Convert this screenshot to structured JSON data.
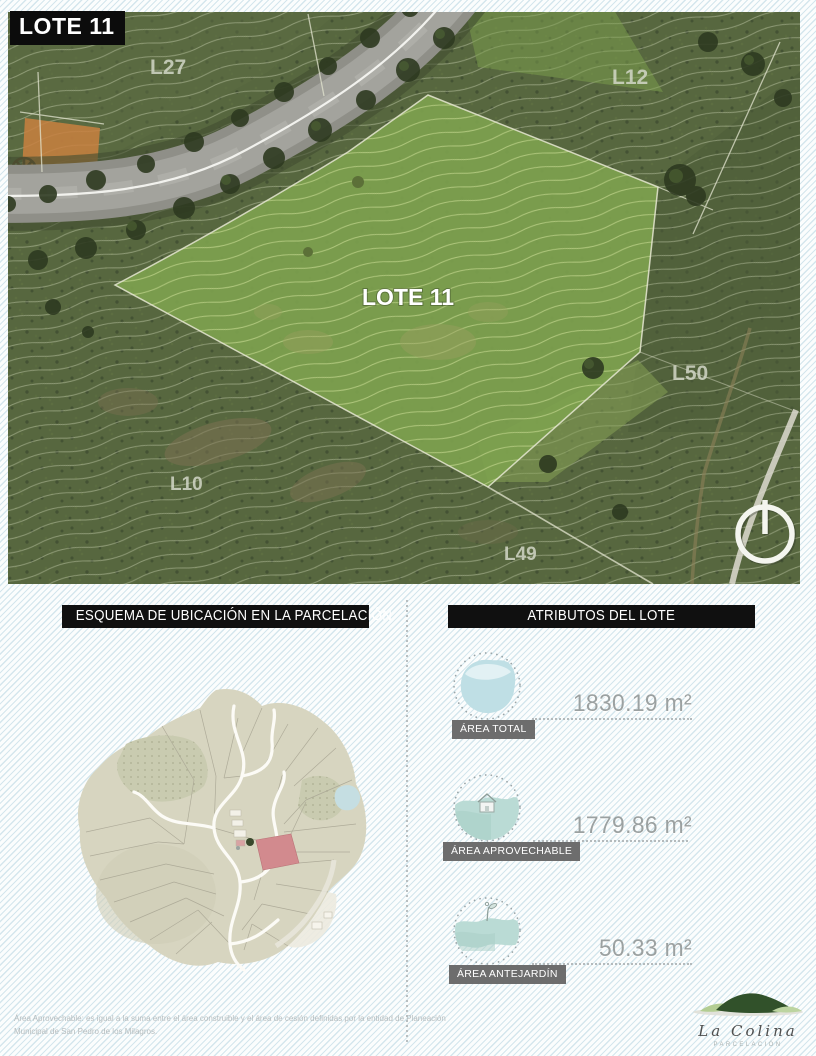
{
  "page": {
    "badge": "LOTE 11"
  },
  "aerial": {
    "center_label": "LOTE 11",
    "labels": {
      "l27": "L27",
      "l12": "L12",
      "l50": "L50",
      "l10": "L10",
      "l49": "L49"
    }
  },
  "location_section": {
    "header": "ESQUEMA DE UBICACIÓN EN LA PARCELACIÓN"
  },
  "attributes_section": {
    "header": "ATRIBUTOS DEL LOTE",
    "items": [
      {
        "label": "ÁREA TOTAL",
        "value": "1830.19 m²"
      },
      {
        "label": "ÁREA APROVECHABLE",
        "value": "1779.86 m²"
      },
      {
        "label": "ÁREA ANTEJARDÍN",
        "value": "50.33 m²"
      }
    ]
  },
  "footnote": {
    "line1": "Área Aprovechable: es igual a la suma entre el área construible y el área de cesión definidas por la entidad de Planeación",
    "line2": "Municipal de San Pedro de los Milagros."
  },
  "logo": {
    "name": "La Colina",
    "tagline": "PARCELACIÓN"
  },
  "colors": {
    "header_black": "#101010",
    "chip_gray": "#6d6d6d",
    "value_gray": "#9ba1a1",
    "lot_highlight_red": "#d28a8e",
    "aerial_base_green": "#57673f",
    "lot_bright_green": "#7da14e",
    "stripe_blue": "#a5cbd9"
  }
}
